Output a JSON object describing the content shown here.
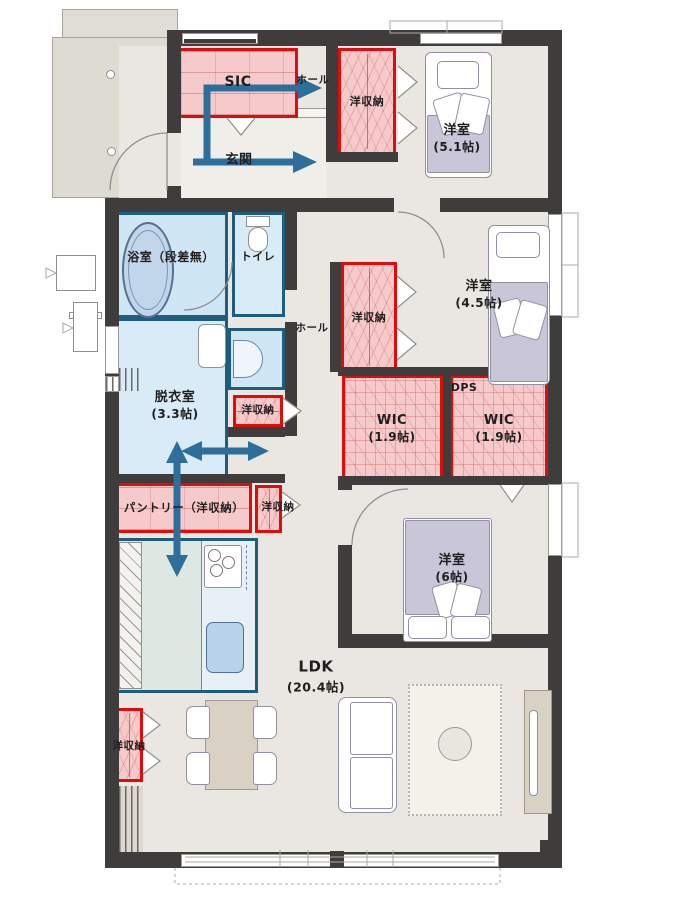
{
  "title": "floor-plan",
  "labels": {
    "sic": "SIC",
    "hall_upper": "ホール",
    "genkan": "玄関",
    "closet_top": "洋収納",
    "bed51_name": "洋室",
    "bed51_area": "(5.1帖)",
    "bath": "浴室（段差無）",
    "toilet": "トイレ",
    "closet_mid": "洋収納",
    "hall_mid": "ホール",
    "bed45_name": "洋室",
    "bed45_area": "(4.5帖)",
    "datsui_name": "脱衣室",
    "datsui_area": "(3.3帖)",
    "closet_wash": "洋収納",
    "wic_left_name": "WIC",
    "wic_left_area": "(1.9帖)",
    "dps": "DPS",
    "wic_right_name": "WIC",
    "wic_right_area": "(1.9帖)",
    "pantry": "パントリー（洋収納）",
    "closet_pantry": "洋収納",
    "bed6_name": "洋室",
    "bed6_area": "(6帖)",
    "ldk_name": "LDK",
    "ldk_area": "(20.4帖)",
    "closet_ldk": "洋収納"
  },
  "colors": {
    "storage_border": "#dc0d0d",
    "storage_fill": "#f6caca",
    "wet_border": "#1f5d7e",
    "wet_fill": "#d8ebf7",
    "kitchen_fill": "#dde8e3",
    "wall": "#3f3d3c",
    "arrow": "#2d6f9a",
    "bed_fill": "#c9c6da",
    "wood_fill": "#d9d2c4"
  }
}
